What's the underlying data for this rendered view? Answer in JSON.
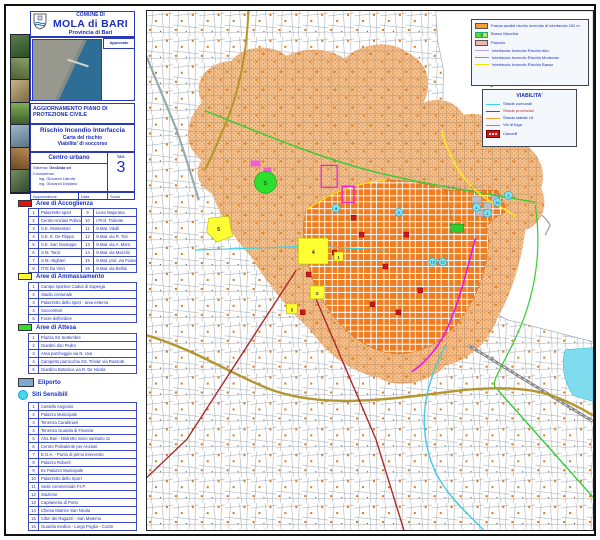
{
  "colors": {
    "accent_blue_text": "#1c2fbd",
    "fascia_fill": "#f3bb82",
    "urban_orange": "#ef7d22",
    "risk_high_line": "#ff4fd0",
    "risk_low_line": "#f5e400",
    "road_statale": "#b5962d",
    "road_provinciale": "#aa2a2a",
    "road_comunale": "#35d5e8",
    "via_di_fuga": "#33cc33",
    "accoglienza_red": "#e01212",
    "ammassamento_yellow": "#ffff33",
    "attesa_green": "#2ee02e",
    "eliporto_blue": "#7fa8d0",
    "siti_cyan": "#46d6f0"
  },
  "title_block": {
    "comune_line": "COMUNE DI",
    "name": "MOLA di BARI",
    "provincia": "Provincia di Bari",
    "approvato_label": "Approvato",
    "update_line1": "AGGIORNAMENTO PIANO DI",
    "update_line2": "PROTEZIONE CIVILE",
    "subject_title": "Rischio Incendio Interfaccia",
    "subject_sub1": "Carta del rischio",
    "subject_sub2": "Viabilita' di soccorso",
    "area_label": "Centro urbano",
    "tav_label": "TAV:",
    "tav_number": "3",
    "sistema_label": "Sistema:",
    "sistema_value": "GeoData srl",
    "consulenza_label": "Consulenza:",
    "consultant1": "ing. Giovanni Latrofa",
    "consultant2": "ing. Giovanni Depiano",
    "approvazione_label": "Approvazione",
    "data_label": "Data",
    "scala_label": "Scala"
  },
  "legend_accoglienza": {
    "title": "Aree di Accoglienza",
    "items": [
      {
        "n": "1",
        "name": "Palazzetto sport"
      },
      {
        "n": "2",
        "name": "Centro Anziani Polival."
      },
      {
        "n": "3",
        "name": "S.E. Montessori"
      },
      {
        "n": "4",
        "name": "S.E. E. De Filippo"
      },
      {
        "n": "5",
        "name": "S.E. San Giuseppe"
      },
      {
        "n": "6",
        "name": "S.M. Tanzi"
      },
      {
        "n": "7",
        "name": "S.M. Alighieri"
      },
      {
        "n": "8",
        "name": "ITIS Da Vinci"
      },
      {
        "n": "9",
        "name": "Liceo Majorana"
      },
      {
        "n": "10",
        "name": "I.Prof. Tridente"
      },
      {
        "n": "11",
        "name": "S.Mat. Vitulli"
      },
      {
        "n": "12",
        "name": "S.Mat. via R. Toti"
      },
      {
        "n": "13",
        "name": "S.Mat. via A. Moro"
      },
      {
        "n": "14",
        "name": "S.Mat. via Mazzini"
      },
      {
        "n": "15",
        "name": "S.Mat. prol. via Fiume"
      },
      {
        "n": "16",
        "name": "S.Mat. via Bellini"
      }
    ]
  },
  "legend_ammassamento": {
    "title": "Aree di Ammassamento",
    "items": [
      {
        "n": "1",
        "name": "Campo sportivo Caduti di Superga"
      },
      {
        "n": "2",
        "name": "Stadio comunale"
      },
      {
        "n": "3",
        "name": "Palazzetto dello sport - area esterna"
      },
      {
        "n": "4",
        "name": "Soccorritori"
      },
      {
        "n": "5",
        "name": "Forze dell'ordine"
      }
    ]
  },
  "legend_attesa": {
    "title": "Aree di Attesa",
    "items": [
      {
        "n": "1",
        "name": "Piazza XX Settembre"
      },
      {
        "n": "2",
        "name": "Giardini don Pedro"
      },
      {
        "n": "3",
        "name": "Area parcheggio via N. Uva"
      },
      {
        "n": "4",
        "name": "Campetto parrocchia SS. Trinita' via Russotti"
      },
      {
        "n": "5",
        "name": "Giardino Botanico via R. De Nicola"
      }
    ]
  },
  "legend_eliporto": {
    "title": "Eliporto"
  },
  "legend_siti": {
    "title": "Siti Sensibili",
    "items": [
      {
        "n": "1",
        "name": "Castello Angioino"
      },
      {
        "n": "2",
        "name": "Palazzo Municipale"
      },
      {
        "n": "3",
        "name": "Tenenza Carabinieri"
      },
      {
        "n": "4",
        "name": "Tenenza Guardia di Finanza"
      },
      {
        "n": "5",
        "name": "ASL Bari - Distretto socio sanitario 11"
      },
      {
        "n": "6",
        "name": "Centro Polivalente per Anziani"
      },
      {
        "n": "7",
        "name": "E.G.A. - Punto di primo intervento"
      },
      {
        "n": "8",
        "name": "Palazzo Roberti"
      },
      {
        "n": "9",
        "name": "Ex Palazzo Municipale"
      },
      {
        "n": "10",
        "name": "Palazzetto dello Sport"
      },
      {
        "n": "11",
        "name": "Sede commerciale F.I.P."
      },
      {
        "n": "12",
        "name": "Stazione"
      },
      {
        "n": "13",
        "name": "Capitaneria di Porto"
      },
      {
        "n": "14",
        "name": "Chiesa Matrice San Nicola"
      },
      {
        "n": "15",
        "name": "Citta' dei Ragazzi - San Materno"
      },
      {
        "n": "16",
        "name": "Guardia medica - Largo Puglia - Cozze"
      }
    ]
  },
  "map_legend_risk": {
    "items": [
      {
        "label": "Fascia analisi rischio incendio di interfaccia 200 m"
      },
      {
        "label": "Bosco Macchia"
      },
      {
        "label": "Pascolo"
      },
      {
        "label": "Interfaccia Incendio Rischio Alto"
      },
      {
        "label": "Interfaccia Incendio Rischio Moderato"
      },
      {
        "label": "Interfaccia Incendio Rischio Basso"
      }
    ]
  },
  "map_legend_viability": {
    "title": "VIABILITA'",
    "items": [
      {
        "label": "Strade  comunali"
      },
      {
        "label": "Strade provinciali"
      },
      {
        "label": "Strada statale 16"
      },
      {
        "label": "Vie di fuga"
      },
      {
        "label": "Cancelli"
      }
    ]
  },
  "map": {
    "place_label": "MOLA DI BARI",
    "markers": [
      {
        "type": "yellow-square",
        "label": "5"
      },
      {
        "type": "yellow-square",
        "label": "4"
      },
      {
        "type": "yellow-square",
        "label": "1"
      },
      {
        "type": "yellow-square",
        "label": "2"
      },
      {
        "type": "yellow-square",
        "label": "3"
      },
      {
        "type": "green-circle",
        "label": "5"
      },
      {
        "type": "cyan-circle",
        "label": "1"
      },
      {
        "type": "cyan-circle",
        "label": "2"
      },
      {
        "type": "cyan-circle",
        "label": "13"
      },
      {
        "type": "cyan-circle",
        "label": "3"
      },
      {
        "type": "cyan-circle",
        "label": "8"
      },
      {
        "type": "cyan-circle",
        "label": "9"
      },
      {
        "type": "cyan-circle",
        "label": "10"
      },
      {
        "type": "cyan-circle",
        "label": "12"
      }
    ]
  }
}
